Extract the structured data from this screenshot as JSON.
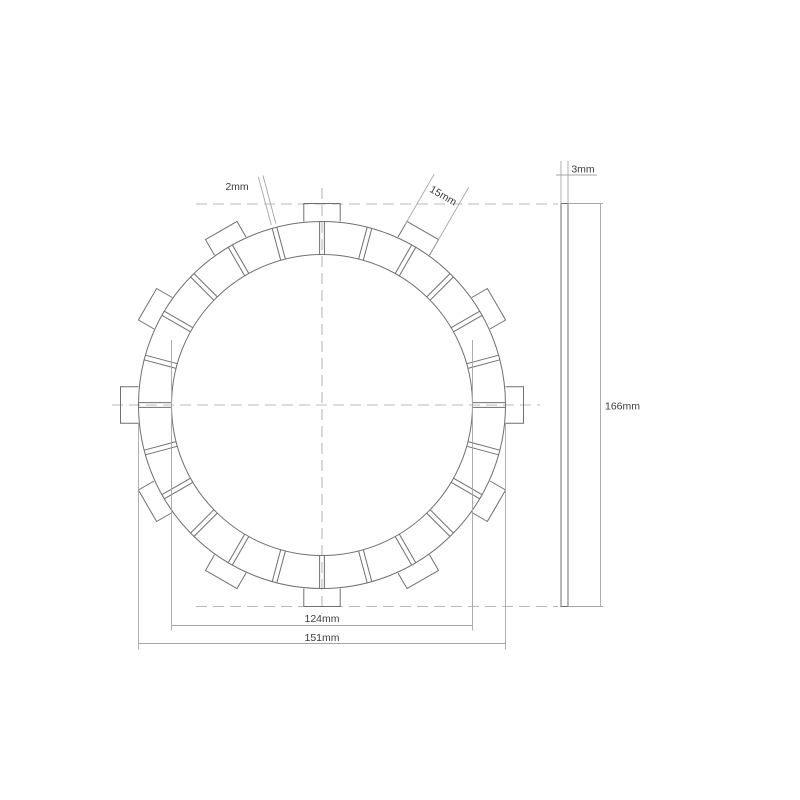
{
  "title": "Clutch friction plate technical drawing",
  "front_view": {
    "slot_width_label": "2mm",
    "tab_width_label": "15mm",
    "inner_diameter_label": "124mm",
    "friction_outer_diameter_label": "151mm"
  },
  "side_view": {
    "thickness_label": "3mm",
    "overall_diameter_label": "166mm"
  },
  "geometry": {
    "tab_count": 12,
    "pad_count": 24,
    "tab_spacing_deg": 30,
    "slot_spacing_deg": 15
  },
  "style": {
    "line_color": "#6f6f6f",
    "thin_line_color": "#a6a6a6",
    "centerline_color": "#b8b8b8",
    "text_color": "#3c3c3c",
    "background": "#ffffff"
  }
}
